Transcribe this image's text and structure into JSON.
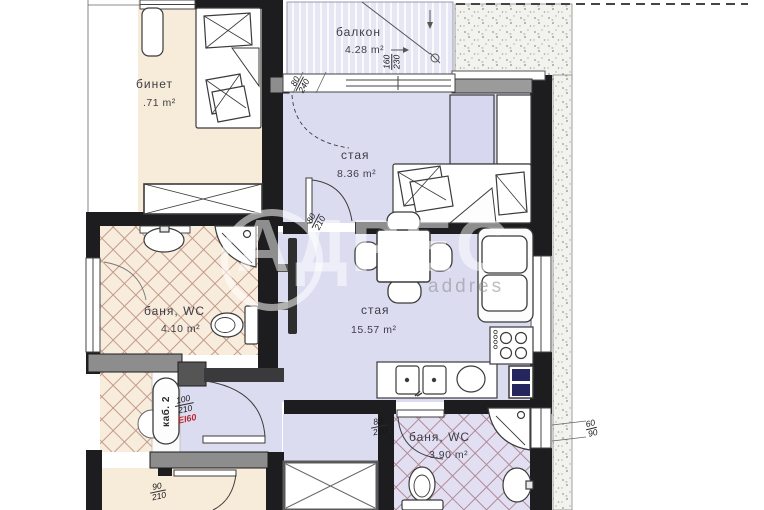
{
  "rooms": {
    "office": {
      "name": "бинет",
      "area": ".71 m²"
    },
    "balcony": {
      "name": "балкон",
      "area": "4.28 m²"
    },
    "bedroom": {
      "name": "стая",
      "area": "8.36 m²"
    },
    "bath1": {
      "name": "баня, WC",
      "area": "4.10 m²"
    },
    "living": {
      "name": "стая",
      "area": "15.57 m²"
    },
    "bath2": {
      "name": "баня, WC",
      "area": "3.90 m²"
    }
  },
  "dimensions": {
    "balcony_door": {
      "w": "80",
      "h": "240"
    },
    "balcony_window": {
      "w": "160",
      "h": "230"
    },
    "bedroom_door": {
      "w": "80",
      "h": "210"
    },
    "bath2_door": {
      "w": "80",
      "h": "210"
    },
    "entry_door": {
      "w": "100",
      "h": "210",
      "fire": "EI60"
    },
    "bottom_room_door": {
      "w": "90",
      "h": "210"
    },
    "right_window": {
      "w": "60",
      "h": "90"
    }
  },
  "labels": {
    "elevator": "каб. 2"
  },
  "watermark": {
    "brand": "АДРЕС",
    "sub": "addres"
  },
  "colors": {
    "room_cream": "#f7ebd9",
    "room_lavender": "#dcdcf1",
    "wall": "#1d1d1f",
    "tile_warm_line": "#c49a8a",
    "tile_cool_line": "#b08a96",
    "fire_label_red": "#c0282d"
  }
}
